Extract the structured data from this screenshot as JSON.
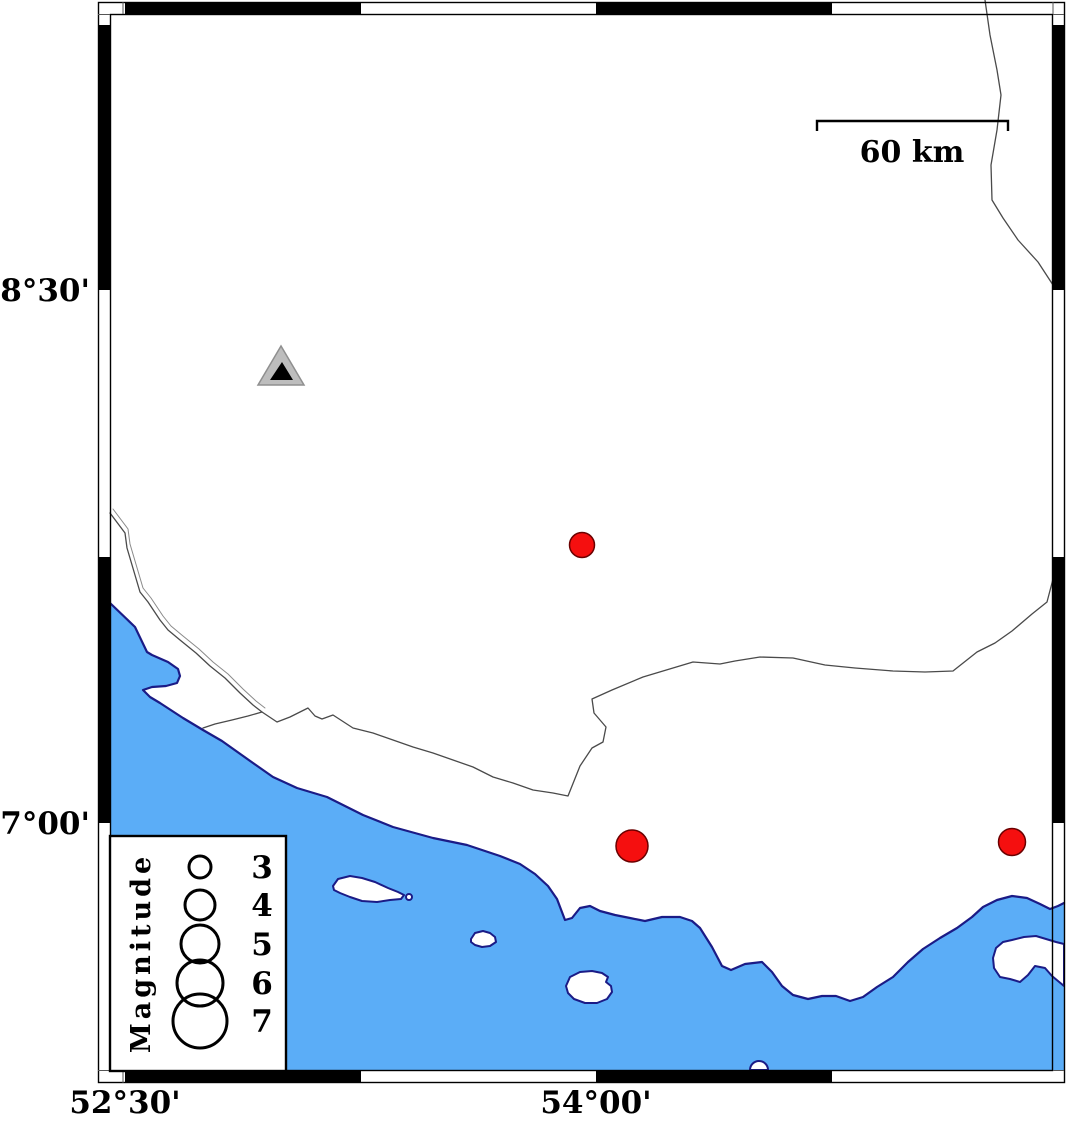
{
  "map": {
    "type": "seismicity-map",
    "projection": "mercator",
    "colors": {
      "sea": "#5badf7",
      "coastline": "#1b1b86",
      "land": "#ffffff",
      "political_border": "#4a4a4a",
      "epicenter_fill": "#f50f0f",
      "epicenter_stroke": "#6b0000",
      "station_outer_fill": "#bdbdbd",
      "station_outer_stroke": "#8f8f8f",
      "station_inner_fill": "#000000",
      "frame_black": "#000000",
      "frame_white": "#ffffff"
    },
    "lat_labels": [
      {
        "text": "28°30'",
        "y": 290
      },
      {
        "text": "27°00'",
        "y": 823
      }
    ],
    "lon_labels": [
      {
        "text": "52°30'",
        "x": 125
      },
      {
        "text": "54°00'",
        "x": 596
      }
    ],
    "frame": {
      "lon_tick_px": [
        125,
        361,
        596,
        832
      ],
      "lat_tick_px": [
        25,
        290,
        557,
        823
      ],
      "tick_interval": "45'"
    },
    "scale_bar": {
      "label": "60 km",
      "x1": 817,
      "x2": 1008,
      "y": 121
    },
    "legend": {
      "title": "Magnitude",
      "entries": [
        {
          "magnitude": "3",
          "radius_px": 11
        },
        {
          "magnitude": "4",
          "radius_px": 15
        },
        {
          "magnitude": "5",
          "radius_px": 19
        },
        {
          "magnitude": "6",
          "radius_px": 23
        },
        {
          "magnitude": "7",
          "radius_px": 27
        }
      ]
    },
    "stations": [
      {
        "symbol": "triangle",
        "x": 281,
        "y": 369,
        "lon_approx": "53.00E",
        "lat_approx": "28.28N"
      }
    ],
    "epicenters": [
      {
        "x": 582,
        "y": 545,
        "radius_px": 12.5,
        "magnitude_approx": 3.4,
        "lon_approx": "53.96E",
        "lat_approx": "27.78N"
      },
      {
        "x": 632,
        "y": 846,
        "radius_px": 16,
        "magnitude_approx": 4.2,
        "lon_approx": "54.11E",
        "lat_approx": "26.93N"
      },
      {
        "x": 1012,
        "y": 842,
        "radius_px": 13.5,
        "magnitude_approx": 3.6,
        "lon_approx": "55.32E",
        "lat_approx": "26.95N"
      }
    ]
  }
}
